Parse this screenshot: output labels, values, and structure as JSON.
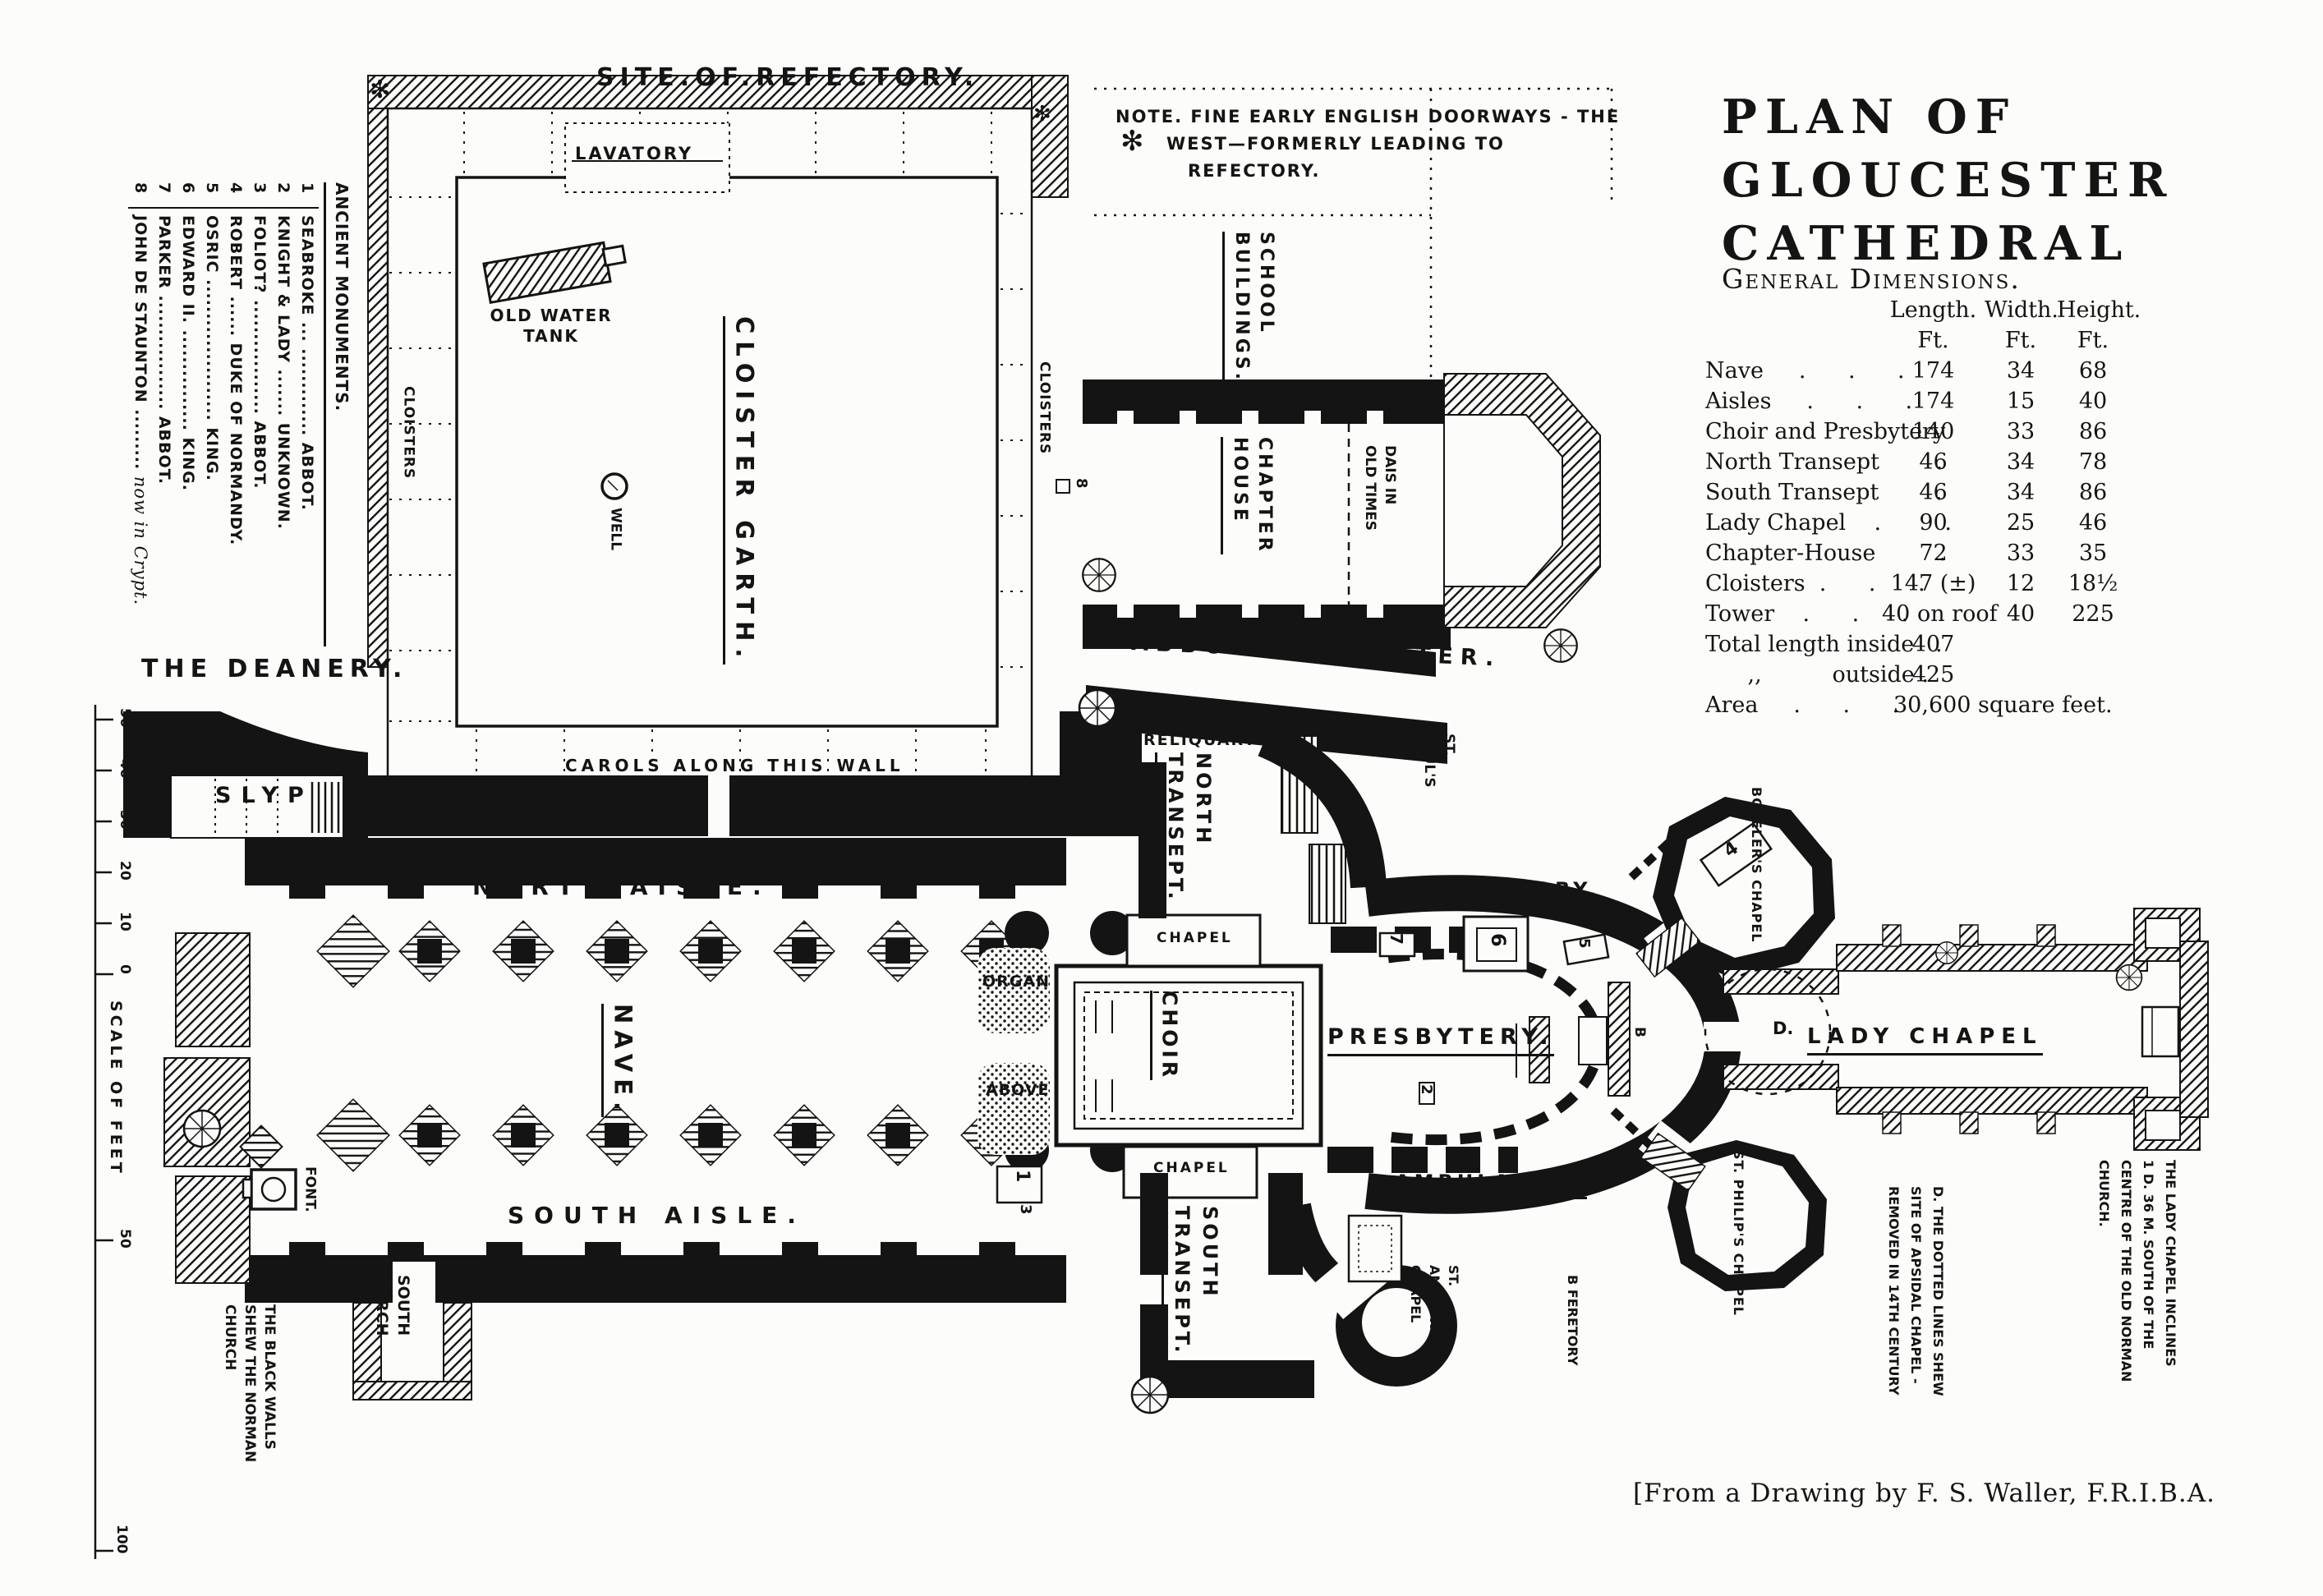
{
  "doc": {
    "title_lines": [
      "PLAN OF",
      "GLOUCESTER",
      "CATHEDRAL"
    ],
    "dimensions_heading": "General Dimensions.",
    "attribution": "[From a Drawing by F. S. Waller, F.R.I.B.A."
  },
  "dimensions": {
    "col_headers": [
      "Length.",
      "Width.",
      "Height."
    ],
    "unit_row": [
      "Ft.",
      "Ft.",
      "Ft."
    ],
    "rows": [
      {
        "name": "Nave     .      .      .",
        "len": "174",
        "wid": "34",
        "hei": "68"
      },
      {
        "name": "Aisles     .      .      .",
        "len": "174",
        "wid": "15",
        "hei": "40"
      },
      {
        "name": "Choir and Presbytery",
        "len": "140",
        "wid": "33",
        "hei": "86"
      },
      {
        "name": "North Transept        .",
        "len": "46",
        "wid": "34",
        "hei": "78"
      },
      {
        "name": "South Transept        .",
        "len": "46",
        "wid": "34",
        "hei": "86"
      },
      {
        "name": "Lady Chapel    .         .",
        "len": "90",
        "wid": "25",
        "hei": "46"
      },
      {
        "name": "Chapter-House         .",
        "len": "72",
        "wid": "33",
        "hei": "35"
      },
      {
        "name": "Cloisters  .      .      .",
        "len": "147 (±)",
        "wid": "12",
        "hei": "18½"
      },
      {
        "name": "Tower    .      .      .",
        "len": "40 on roof",
        "wid": "40",
        "hei": "225"
      },
      {
        "name": "Total length inside   .",
        "len": "407",
        "wid": "",
        "hei": ""
      },
      {
        "name": "      ,,          outside .",
        "len": "425",
        "wid": "",
        "hei": ""
      },
      {
        "name": "Area     .      .      .",
        "len": "30,600 square feet.",
        "wid": "",
        "hei": ""
      }
    ]
  },
  "note": {
    "icon": "✻",
    "line1": "NOTE. FINE EARLY ENGLISH DOORWAYS - THE",
    "line2": "WEST—FORMERLY  LEADING  TO",
    "line3": "REFECTORY."
  },
  "monuments": {
    "heading": "ANCIENT MONUMENTS.",
    "items": [
      {
        "num": "1",
        "name": "SEABROKE",
        "leader": "... .............",
        "title": "ABBOT."
      },
      {
        "num": "2",
        "name": "KNIGHT & LADY",
        "leader": ".......",
        "title": "UNKNOWN."
      },
      {
        "num": "3",
        "name": "FOLIOT?",
        "leader": ".................",
        "title": "ABBOT."
      },
      {
        "num": "4",
        "name": "ROBERT",
        "leader": "......",
        "title": "DUKE OF NORMANDY."
      },
      {
        "num": "5",
        "name": "OSRIC",
        "leader": ".....................",
        "title": "KING."
      },
      {
        "num": "6",
        "name": "EDWARD II.",
        "leader": "...............",
        "title": "KING."
      },
      {
        "num": "7",
        "name": "PARKER",
        "leader": ".................",
        "title": "ABBOT."
      },
      {
        "num": "8",
        "name": "JOHN DE STAUNTON",
        "leader": ".........",
        "title": "now in Crypt."
      }
    ]
  },
  "plan": {
    "ornament": "✻",
    "labels": {
      "site_of_refectory": "SITE.OF.REFECTORY.",
      "lavatory": "LAVATORY",
      "old_water_tank": "OLD WATER\nTANK",
      "well": "WELL",
      "cloister_garth": "CLOISTER GARTH.",
      "cloisters_left": "CLOISTERS",
      "cloisters_right": "CLOISTERS",
      "carols": "CAROLS ALONG THIS WALL",
      "the_deanery": "THE DEANERY.",
      "slyp": "SLYP",
      "north_aisle": "NORTH AISLE.",
      "nave": "NAVE.",
      "south_aisle": "SOUTH AISLE.",
      "font": "FONT.",
      "south_porch": "SOUTH\nPORCH",
      "black_walls": "THE BLACK WALLS\nSHEW THE NORMAN\nCHURCH",
      "school_buildings": "SCHOOL\nBUILDINGS.",
      "chapter_house": "CHAPTER\nHOUSE",
      "dais": "DAIS IN\nOLD TIMES",
      "abbots_cloister": "ABBOT'S  CLOISTER.",
      "reliquary": "RELIQUARY",
      "north_transept": "NORTH\nTRANSEPT.",
      "south_transept": "SOUTH\nTRANSEPT.",
      "st_pauls": "ST.\nPAUL'S\nCH.",
      "ambulatory_north": "AMBULATORY,",
      "ambulatory_south": "AMBULATORY",
      "presbytery": "PRESBYTERY.",
      "choir": "CHOIR",
      "organ": "ORGAN",
      "above": "ABOVE",
      "chapel_north": "CHAPEL",
      "chapel_south": "CHAPEL",
      "botelers": "BOTELER'S CHAPEL",
      "st_philips": "ST. PHILIP'S CHAPEL",
      "st_andrews": "ST.\nANDREW'S\nCHAPEL",
      "feretory": "B  FERETORY",
      "lady_chapel": "LADY  CHAPEL",
      "lady_note": "THE LADY CHAPEL INCLINES\n1 D. 36 M. SOUTH OF THE\nCENTRE OF THE OLD NORMAN\nCHURCH.",
      "dotted_note": "D. THE DOTTED LINES SHEW\nSITE OF APSIDAL CHAPEL -\nREMOVED IN 14TH CENTURY"
    },
    "markers": {
      "m1": "1",
      "m2": "2",
      "m3": "3",
      "m4": "4",
      "m5": "5",
      "m6": "6",
      "m7": "7",
      "m8": "8",
      "b": "B",
      "d": "D."
    },
    "scale": {
      "ticks": [
        "50",
        "40",
        "30",
        "20",
        "10",
        "0"
      ],
      "mid": "50",
      "end": "100",
      "label": "SCALE OF FEET"
    }
  }
}
